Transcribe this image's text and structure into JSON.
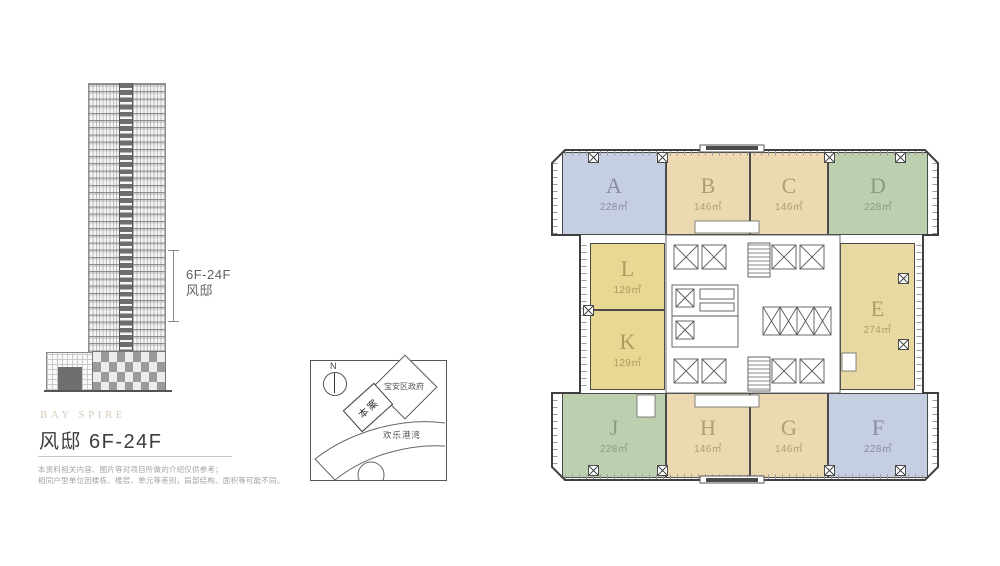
{
  "project": {
    "brand": "BAY SPIRE",
    "title": "风邸 6F-24F",
    "disclaimer_line1": "本资料相关内容、图片等对项目所做的介绍仅供参考；",
    "disclaimer_line2": "相同户型单位因楼栋、楼层、单元等差别，局部结构、面积等可能不同。"
  },
  "elevation": {
    "range_line1": "6F-24F",
    "range_line2": "风邸"
  },
  "map": {
    "north_label": "N",
    "site_label": "本案",
    "government_label": "宝安区政府",
    "bay_label": "欢乐港湾"
  },
  "plan": {
    "units": [
      {
        "letter": "A",
        "area": "228㎡",
        "color": "#c6cee1"
      },
      {
        "letter": "B",
        "area": "146㎡",
        "color": "#ecd9b1"
      },
      {
        "letter": "C",
        "area": "146㎡",
        "color": "#ecd9b1"
      },
      {
        "letter": "D",
        "area": "228㎡",
        "color": "#bccfaf"
      },
      {
        "letter": "E",
        "area": "274㎡",
        "color": "#e8d9a2"
      },
      {
        "letter": "F",
        "area": "228㎡",
        "color": "#c6cee1"
      },
      {
        "letter": "G",
        "area": "146㎡",
        "color": "#ecd9b1"
      },
      {
        "letter": "H",
        "area": "146㎡",
        "color": "#ecd9b1"
      },
      {
        "letter": "J",
        "area": "228㎡",
        "color": "#bccfaf"
      },
      {
        "letter": "K",
        "area": "129㎡",
        "color": "#e9d894"
      },
      {
        "letter": "L",
        "area": "129㎡",
        "color": "#e9d894"
      }
    ]
  }
}
